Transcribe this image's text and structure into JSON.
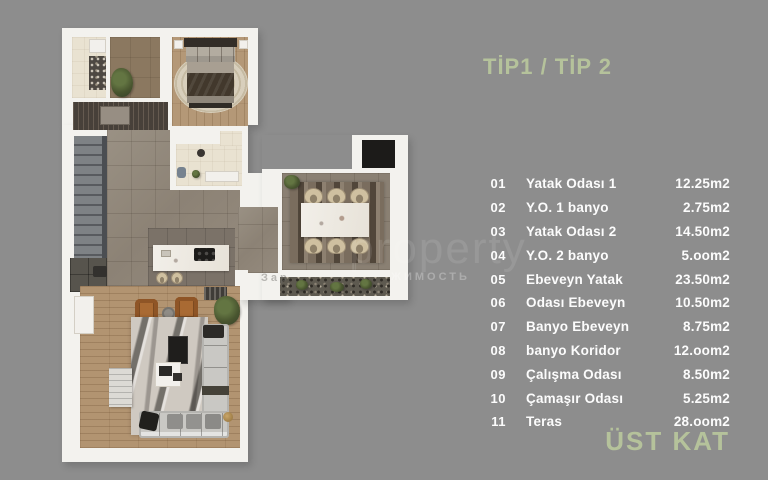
{
  "title": "TİP1 / TİP 2",
  "footer": "ÜST KAT",
  "watermark": {
    "big": "property",
    "left_fragment": "Зар",
    "right_fragment": "ЖИМОСТЬ"
  },
  "colors": {
    "background": "#8d8d8d",
    "accent_green": "#b5c29b",
    "list_text": "#fcfcfc",
    "walls": "#f3f2ee"
  },
  "rooms": [
    {
      "no": "01",
      "name": "Yatak Odası 1",
      "area": "12.25m2"
    },
    {
      "no": "02",
      "name": "Y.O. 1 banyo",
      "area": "2.75m2"
    },
    {
      "no": "03",
      "name": "Yatak Odası 2",
      "area": "14.50m2"
    },
    {
      "no": "04",
      "name": "Y.O. 2 banyo",
      "area": "5.oom2"
    },
    {
      "no": "05",
      "name": "Ebeveyn Yatak",
      "area": "23.50m2"
    },
    {
      "no": "06",
      "name": "Odası Ebeveyn",
      "area": "10.50m2"
    },
    {
      "no": "07",
      "name": "Banyo Ebeveyn",
      "area": "8.75m2"
    },
    {
      "no": "08",
      "name": "banyo Koridor",
      "area": "12.oom2"
    },
    {
      "no": "09",
      "name": "Çalışma Odası",
      "area": "8.50m2"
    },
    {
      "no": "10",
      "name": "Çamaşır Odası",
      "area": "5.25m2"
    },
    {
      "no": "11",
      "name": "Teras",
      "area": "28.oom2"
    }
  ]
}
